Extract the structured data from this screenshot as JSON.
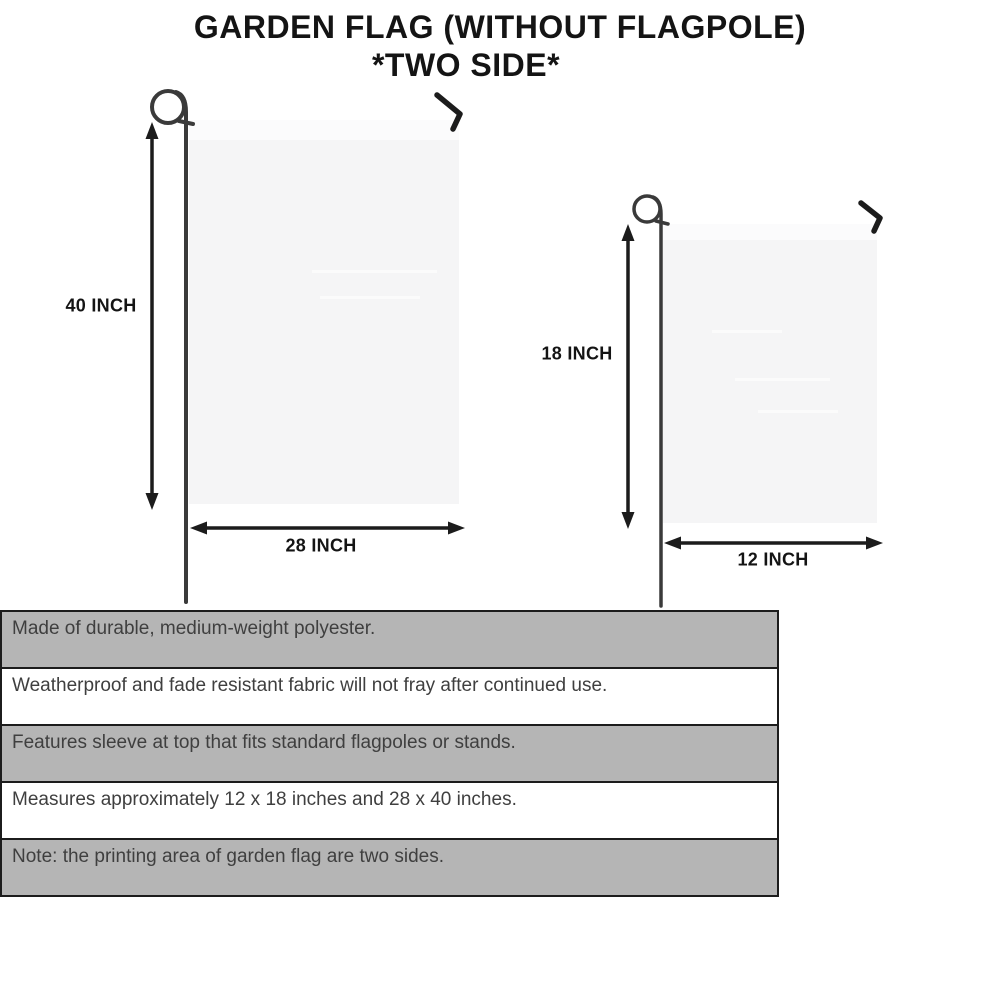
{
  "title": {
    "line1": "GARDEN FLAG (WITHOUT FLAGPOLE)",
    "line2": "*TWO SIDE*"
  },
  "diagrams": {
    "large_flag": {
      "height_label": "40 INCH",
      "width_label": "28 INCH"
    },
    "small_flag": {
      "height_label": "18 INCH",
      "width_label": "12 INCH"
    }
  },
  "features": [
    {
      "text": "Made of durable, medium-weight polyester.",
      "shaded": true
    },
    {
      "text": "Weatherproof and fade resistant fabric will not fray after continued use.",
      "shaded": false
    },
    {
      "text": "Features sleeve at top that fits standard flagpoles or stands.",
      "shaded": true
    },
    {
      "text": "Measures approximately 12 x 18 inches and 28 x 40 inches.",
      "shaded": false
    },
    {
      "text": "Note: the printing area of garden flag are two sides.",
      "shaded": true
    }
  ],
  "colors": {
    "band_gray": "#b5b5b5",
    "row_white": "#ffffff",
    "flag_fill": "#f5f5f6",
    "flag_sleeve": "#fbfbfc",
    "line_black": "#1c1c1c",
    "pole_gray": "#3a3a3a",
    "text_dark": "#3f3f3f",
    "title_black": "#141414"
  }
}
